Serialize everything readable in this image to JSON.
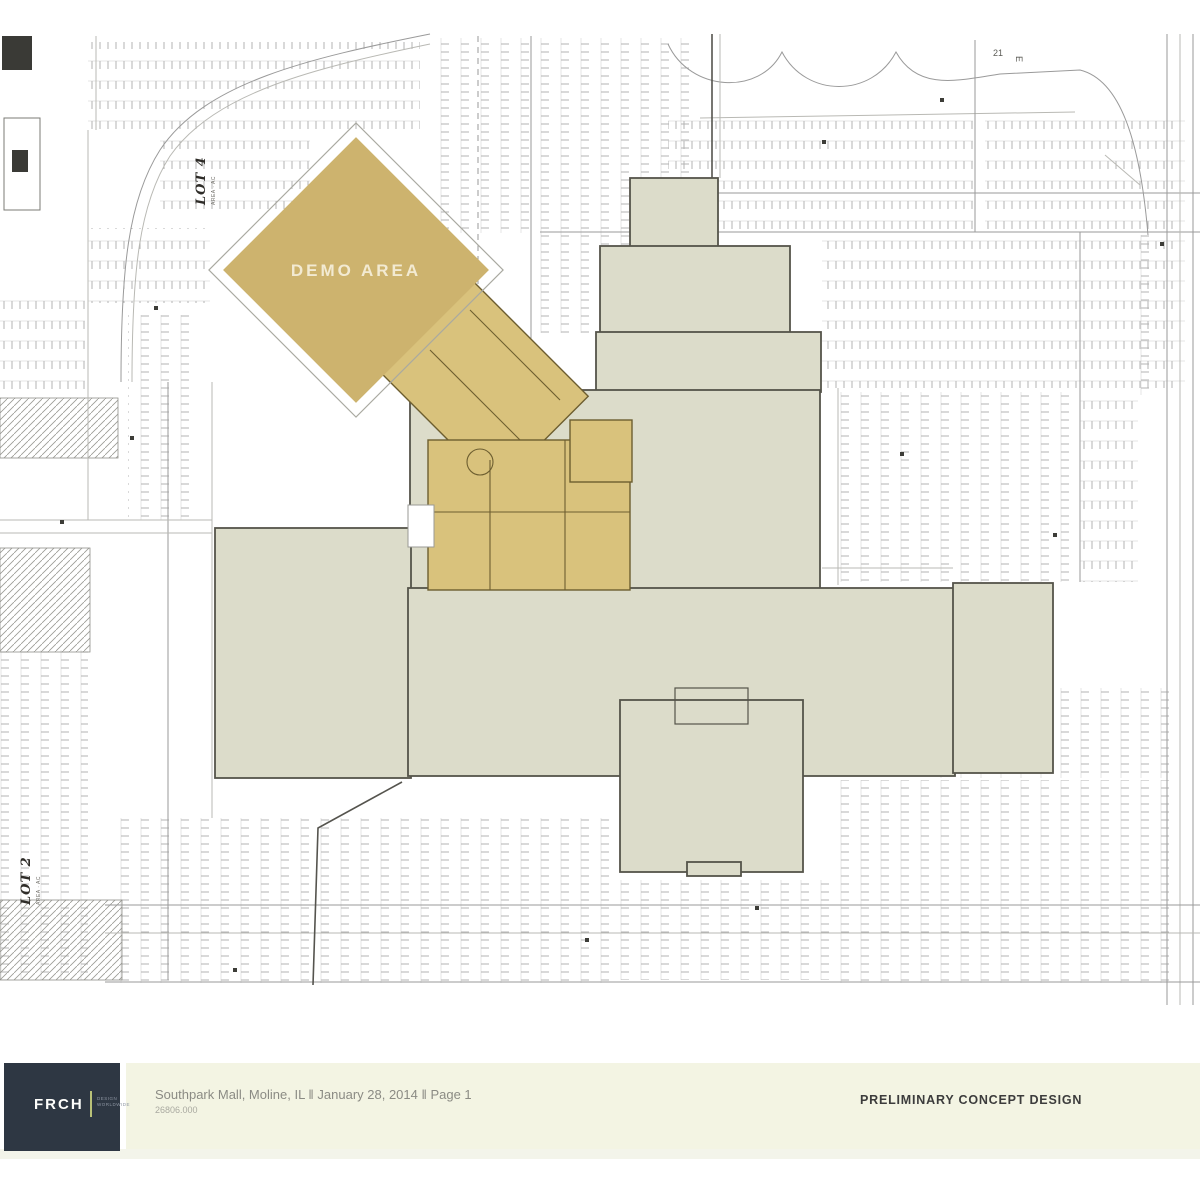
{
  "plan": {
    "labels": {
      "demo_area": "DEMO AREA",
      "lot4": {
        "title": "LOT 4",
        "sub": "AREA · AC"
      },
      "lot2": {
        "title": "LOT 2",
        "sub": "AREA · AC"
      },
      "marks": {
        "m1": "21",
        "m2": "E"
      }
    },
    "colors": {
      "building_fill": "#dcdcca",
      "building_stroke": "#55544a",
      "demo_fill": "#cdb36e",
      "demo_label": "#f2ead2",
      "corridor_fill": "#d9c27c",
      "corridor_stroke": "#6d5e30",
      "parking_line": "#b3b3b3",
      "road_line": "#9a9a9a"
    }
  },
  "footer": {
    "logo": {
      "brand": "FRCH",
      "tagline_line1": "DESIGN",
      "tagline_line2": "WORLDWIDE"
    },
    "project_line": "Southpark Mall, Moline, IL ‖ January 28, 2014 ‖ Page 1",
    "job_number": "26806.000",
    "stamp": "PRELIMINARY CONCEPT DESIGN",
    "colors": {
      "bar_bg": "#f3f4e3",
      "logo_bg": "#2e3743",
      "stamp_color": "#3c3c3c",
      "text_color": "#8b8b84"
    }
  }
}
